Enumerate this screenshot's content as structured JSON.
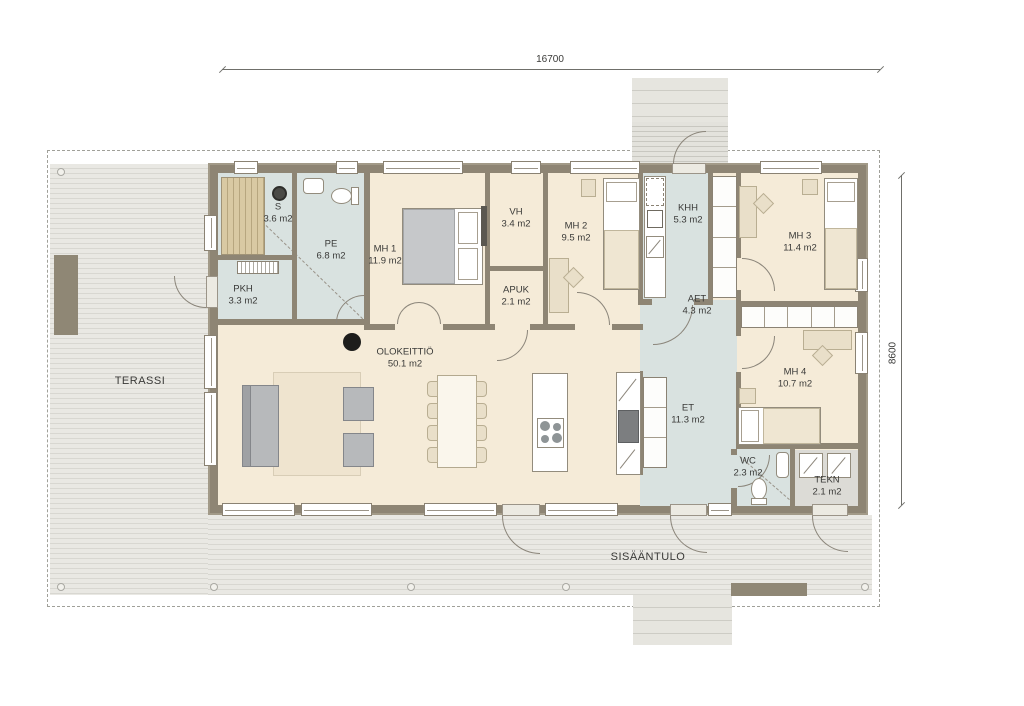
{
  "plan": {
    "zone_labels": {
      "terrace": "TERASSI",
      "entrance": "SISÄÄNTULO"
    },
    "dimensions": {
      "width": "16700",
      "height": "8600"
    },
    "rooms": [
      {
        "id": "s",
        "name": "S",
        "area": "3.6 m2"
      },
      {
        "id": "pe",
        "name": "PE",
        "area": "6.8 m2"
      },
      {
        "id": "pkh",
        "name": "PKH",
        "area": "3.3 m2"
      },
      {
        "id": "mh1",
        "name": "MH 1",
        "area": "11.9 m2"
      },
      {
        "id": "vh",
        "name": "VH",
        "area": "3.4 m2"
      },
      {
        "id": "apuk",
        "name": "APUK",
        "area": "2.1 m2"
      },
      {
        "id": "mh2",
        "name": "MH 2",
        "area": "9.5 m2"
      },
      {
        "id": "khh",
        "name": "KHH",
        "area": "5.3 m2"
      },
      {
        "id": "aet",
        "name": "AET",
        "area": "4.3 m2"
      },
      {
        "id": "mh3",
        "name": "MH 3",
        "area": "11.4 m2"
      },
      {
        "id": "olok",
        "name": "OLOKEITTIÖ",
        "area": "50.1 m2"
      },
      {
        "id": "et",
        "name": "ET",
        "area": "11.3 m2"
      },
      {
        "id": "mh4",
        "name": "MH 4",
        "area": "10.7 m2"
      },
      {
        "id": "wc",
        "name": "WC",
        "area": "2.3 m2"
      },
      {
        "id": "tekn",
        "name": "TEKN",
        "area": "2.1 m2"
      }
    ],
    "colors": {
      "wall": "#8e8574",
      "floor_main": "#f5ebd8",
      "floor_wet": "#d9e2e0",
      "floor_tech": "#dcdbd6",
      "deck": "#e9e8e3",
      "accent_dark": "#8f8775"
    }
  }
}
